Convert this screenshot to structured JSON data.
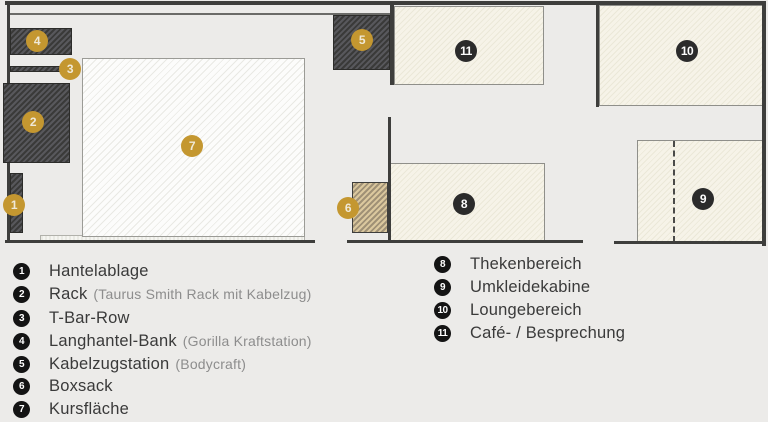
{
  "plan": {
    "markers": [
      {
        "num": "1",
        "color": "gold"
      },
      {
        "num": "2",
        "color": "gold"
      },
      {
        "num": "3",
        "color": "gold"
      },
      {
        "num": "4",
        "color": "gold"
      },
      {
        "num": "5",
        "color": "gold"
      },
      {
        "num": "6",
        "color": "gold"
      },
      {
        "num": "7",
        "color": "gold"
      },
      {
        "num": "8",
        "color": "dark"
      },
      {
        "num": "9",
        "color": "dark"
      },
      {
        "num": "10",
        "color": "dark"
      },
      {
        "num": "11",
        "color": "dark"
      }
    ]
  },
  "legend": {
    "left": [
      {
        "num": "1",
        "label": "Hantelablage",
        "note": ""
      },
      {
        "num": "2",
        "label": "Rack",
        "note": "(Taurus Smith Rack mit Kabelzug)"
      },
      {
        "num": "3",
        "label": "T-Bar-Row",
        "note": ""
      },
      {
        "num": "4",
        "label": "Langhantel-Bank",
        "note": "(Gorilla Kraftstation)"
      },
      {
        "num": "5",
        "label": "Kabelzugstation",
        "note": "(Bodycraft)"
      },
      {
        "num": "6",
        "label": "Boxsack",
        "note": ""
      },
      {
        "num": "7",
        "label": "Kursfläche",
        "note": ""
      }
    ],
    "right": [
      {
        "num": "8",
        "label": "Thekenbereich",
        "note": ""
      },
      {
        "num": "9",
        "label": "Umkleidekabine",
        "note": ""
      },
      {
        "num": "10",
        "label": "Loungebereich",
        "note": ""
      },
      {
        "num": "11",
        "label": "Café- / Besprechung",
        "note": ""
      }
    ]
  },
  "colors": {
    "background": "#ecebe9",
    "wall": "#3e3e3c",
    "equipment_dark": "#4a4a49",
    "boxsack_tan": "#d3bf95",
    "course_area_light": "#f5f5f2",
    "room_cream": "#f4f1e5",
    "marker_gold": "#c49730",
    "marker_dark": "#2b2b2b",
    "legend_text": "#3a3a3a",
    "legend_note": "#8d8d8d"
  }
}
